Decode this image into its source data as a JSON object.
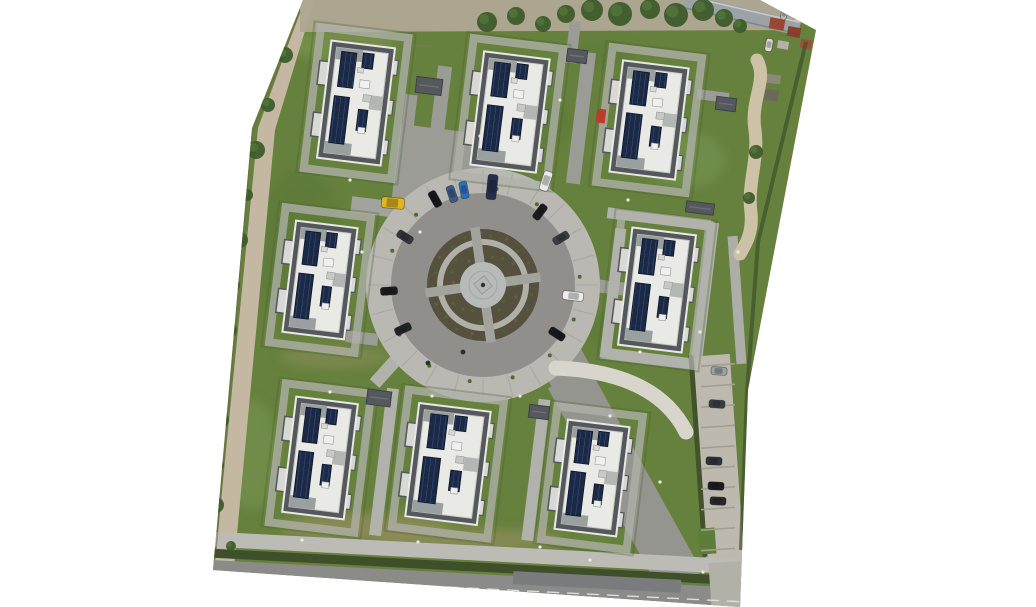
{
  "scene": {
    "description": "aerial-orthophoto-residential-estate-eight-buildings-around-circular-courtyard",
    "canvas": {
      "width": 1036,
      "height": 607
    },
    "boundary_polygon": [
      [
        303,
        0
      ],
      [
        760,
        0
      ],
      [
        816,
        30
      ],
      [
        748,
        390
      ],
      [
        740,
        607
      ],
      [
        213,
        570
      ],
      [
        252,
        128
      ]
    ],
    "colors": {
      "canvas_bg": "#ffffff",
      "grass": "#66813d",
      "asphalt_path": "#9c9c97",
      "light_walkway": "#b2b2ac",
      "plaza_arm": "#a3a39e",
      "drive": "#95958f",
      "ring_outer_pavement": "#b9b8b2",
      "ring_joint": "#a7a6a0",
      "ring_asphalt": "#908f8b",
      "planting": "#56503e",
      "ring_path": "#b0b0a9",
      "plaza": "#b6bbb9",
      "plaza_diamond": "#b2b7b5",
      "building_parapet": "#54575b",
      "building_roof": "#e9e9e5",
      "building_trim": "#e8e8e5",
      "terrace": "#9aa0a0",
      "bay": "#d8d8d4",
      "solar_dark": "#1b2945",
      "solar_line": "#3d5c94",
      "shed": "#55585c",
      "dirt_left": "#c4b8a2",
      "dirt_top": "#b0a694",
      "foliage": "#3d5c2b",
      "foliage_light": "#54763a",
      "hedge": "#3f4f2a",
      "sidewalk": "#bcbbb5",
      "road": "#8b8b89",
      "road_patch": "#7a7b7d",
      "road_line": "#dedede",
      "parking": "#bdb9ae",
      "parking_divider": "#a29e92",
      "parking_hedge": "#42522c",
      "green_patch": "#5d7d3a",
      "beige_path": "#cdc2a6",
      "ramp_wall": "#d8d6cc",
      "long_roof": "#9ba3a7",
      "white_dot": "#eceae4",
      "tuft": "#4e6b33",
      "fence_brown": "#6f6450",
      "hedge_dark": "#3c512b",
      "garden_wall": "#8a7458"
    },
    "left_dirt_polygon": [
      [
        305,
        -2
      ],
      [
        258,
        128
      ],
      [
        215,
        562
      ],
      [
        234,
        566
      ],
      [
        275,
        130
      ],
      [
        315,
        -2
      ]
    ],
    "top_dirt_polygon": [
      [
        300,
        -2
      ],
      [
        792,
        -2
      ],
      [
        795,
        30
      ],
      [
        300,
        32
      ]
    ],
    "lawn_patches": [
      [
        340,
        45,
        55,
        16,
        "#7a9650",
        0.7
      ],
      [
        300,
        250,
        45,
        80,
        "#5a7836",
        0.6
      ],
      [
        365,
        527,
        85,
        13,
        "#938e5e",
        0.75
      ],
      [
        470,
        540,
        95,
        11,
        "#938e5e",
        0.7
      ],
      [
        620,
        330,
        38,
        18,
        "#5a7836",
        0.5
      ],
      [
        685,
        160,
        40,
        28,
        "#779552",
        0.6
      ],
      [
        252,
        455,
        26,
        55,
        "#779552",
        0.55
      ],
      [
        545,
        122,
        28,
        22,
        "#5a7836",
        0.5
      ],
      [
        432,
        470,
        26,
        36,
        "#5f7c38",
        0.5
      ],
      [
        335,
        357,
        55,
        11,
        "#8a8c58",
        0.6
      ],
      [
        605,
        55,
        30,
        14,
        "#5a7836",
        0.5
      ],
      [
        480,
        250,
        30,
        22,
        "#5d7a37",
        0.4
      ]
    ],
    "paths": [
      [
        447,
        167,
        102,
        74,
        7,
        "#9c9c97"
      ],
      [
        390,
        209,
        78,
        16,
        7,
        "#a3a39e"
      ],
      [
        441,
        100,
        14,
        68,
        7,
        "#9c9c97"
      ],
      [
        407,
        132,
        12,
        75,
        7,
        "#9c9c97"
      ],
      [
        581,
        118,
        14,
        132,
        7,
        "#9c9c97"
      ],
      [
        573,
        42,
        11,
        42,
        7,
        "#9c9c97"
      ],
      [
        607,
        287,
        38,
        13,
        7,
        "#9c9c97"
      ],
      [
        659,
        219,
        104,
        11,
        7,
        "#b2b2ac"
      ],
      [
        705,
        292,
        11,
        140,
        7,
        "#b2b2ac"
      ],
      [
        613,
        293,
        11,
        130,
        7,
        "#b2b2ac"
      ],
      [
        661,
        360,
        108,
        11,
        7,
        "#b2b2ac"
      ],
      [
        737,
        300,
        10,
        128,
        -4,
        "#aeaea8"
      ],
      [
        384,
        462,
        12,
        148,
        7,
        "#b2b2ac"
      ],
      [
        536,
        470,
        12,
        142,
        7,
        "#b2b2ac"
      ],
      [
        394,
        362,
        13,
        58,
        42,
        "#b2b2ac"
      ],
      [
        362,
        338,
        32,
        12,
        7,
        "#9c9c97"
      ],
      [
        567,
        369,
        44,
        46,
        -29,
        "#95958f"
      ],
      [
        625,
        480,
        46,
        235,
        -29,
        "#95958f"
      ],
      [
        718,
        458,
        38,
        206,
        -4,
        "#bdb9ae"
      ],
      [
        698,
        456,
        5,
        202,
        -4,
        "#42522c"
      ],
      [
        707,
        541,
        17,
        26,
        -4,
        "#5d7d3a"
      ],
      [
        476,
        553,
        548,
        15,
        3,
        "#bcbbb5"
      ],
      [
        476,
        567,
        548,
        9,
        3,
        "#3f4f2a"
      ],
      [
        477,
        589,
        550,
        30,
        3,
        "#8b8b89"
      ],
      [
        597,
        582,
        168,
        13,
        3,
        "#7a7b7d"
      ],
      [
        727,
        585,
        34,
        46,
        -4,
        "#b3b0a7"
      ],
      [
        713,
        96,
        32,
        10,
        7,
        "#9c9c97"
      ],
      [
        773,
        79,
        15,
        9,
        7,
        "#8d887a"
      ],
      [
        770,
        95,
        17,
        11,
        7,
        "#6b685c"
      ],
      [
        742,
        15,
        118,
        15,
        13,
        "#9ba3a7"
      ],
      [
        742,
        9,
        118,
        1.5,
        13,
        "#c5cbce"
      ],
      [
        742,
        21,
        118,
        1.5,
        13,
        "#7e868a"
      ],
      [
        777,
        24,
        15,
        11,
        10,
        "#9c4632"
      ],
      [
        794,
        32,
        13,
        10,
        10,
        "#8a3f2e"
      ],
      [
        806,
        44,
        11,
        9,
        10,
        "#a04c38"
      ],
      [
        783,
        45,
        11,
        8,
        10,
        "#b5b0a8"
      ],
      [
        800,
        18,
        10,
        8,
        10,
        "#c9c5bd"
      ]
    ],
    "parking_dividers": {
      "cx": 718,
      "y0": 365,
      "step": 20.5,
      "count": 10,
      "w": 34,
      "rot": -4
    },
    "curves": [
      {
        "d": "M 757 60 C 768 80 750 100 755 130 C 759 158 747 185 751 212 C 753 232 746 244 740 254",
        "w": 13,
        "color": "#cdc2a6",
        "dash": ""
      },
      {
        "d": "M 556 368 Q 656 372 686 432",
        "w": 15,
        "color": "#d8d6cc",
        "dash": ""
      },
      {
        "d": "M 208 575 L 746 602",
        "w": 1.4,
        "color": "#dedede",
        "dash": "11 9"
      }
    ],
    "fences": [
      {
        "d": "M 300 12 L 252 132 L 216 550",
        "w": 1.5,
        "color": "#6f6450",
        "op": 0.55
      },
      {
        "d": "M 806 42 L 758 242 L 747 392 L 741 550",
        "w": 4,
        "color": "#3c512b",
        "op": 0.7
      },
      {
        "d": "M 312 96 L 319 38 L 434 47",
        "w": 1.5,
        "color": "#8a7458",
        "op": 0.5
      }
    ],
    "roundabout": {
      "cx": 483,
      "cy": 285,
      "rings": [
        [
          90,
          117,
          "#b9b8b2"
        ],
        [
          55,
          92,
          "#908f8b"
        ],
        [
          45,
          56,
          "#56503e"
        ],
        [
          39,
          46,
          "#b0b0a9"
        ],
        [
          22,
          40,
          "#56503e"
        ]
      ],
      "plaza_r": 23,
      "inner_circle_r": 14,
      "diamond": 13,
      "diamond_rot": 52,
      "arm_angles": [
        352,
        82,
        172,
        262
      ],
      "arm_r1": 21,
      "arm_r2": 58,
      "arm_w": 9.5,
      "joints": 24,
      "tufts": 14
    },
    "building_template": {
      "inset": 6,
      "solar_strips": [
        {
          "x": 0.18,
          "y": 0.08,
          "w": 0.24,
          "h": 0.3
        },
        {
          "x": 0.15,
          "y": 0.46,
          "w": 0.24,
          "h": 0.4
        },
        {
          "x": 0.52,
          "y": 0.07,
          "w": 0.17,
          "h": 0.13
        },
        {
          "x": 0.55,
          "y": 0.55,
          "w": 0.15,
          "h": 0.18
        }
      ],
      "roof_boxes": [
        [
          0.52,
          0.3,
          10,
          8,
          "#f0f0ee"
        ],
        [
          0.6,
          0.42,
          8,
          7,
          "#c8c8c5"
        ],
        [
          0.46,
          0.2,
          6,
          5,
          "#d8d8d5"
        ],
        [
          0.58,
          0.7,
          7,
          6,
          "#eeeeec"
        ]
      ],
      "bays_y": [
        0.18,
        0.62
      ],
      "bumps_y": [
        0.1,
        0.44,
        0.78
      ]
    },
    "buildings": [
      {
        "id": 1,
        "x": 356,
        "y": 103,
        "w": 64,
        "h": 118,
        "rot": 7
      },
      {
        "id": 2,
        "x": 510,
        "y": 112,
        "w": 66,
        "h": 114,
        "rot": 7
      },
      {
        "id": 3,
        "x": 649,
        "y": 120,
        "w": 66,
        "h": 112,
        "rot": 7
      },
      {
        "id": 4,
        "x": 320,
        "y": 280,
        "w": 62,
        "h": 112,
        "rot": 7
      },
      {
        "id": 5,
        "x": 657,
        "y": 290,
        "w": 64,
        "h": 118,
        "rot": 7
      },
      {
        "id": 6,
        "x": 320,
        "y": 458,
        "w": 62,
        "h": 116,
        "rot": 7
      },
      {
        "id": 7,
        "x": 448,
        "y": 464,
        "w": 72,
        "h": 114,
        "rot": 7
      },
      {
        "id": 8,
        "x": 592,
        "y": 478,
        "w": 62,
        "h": 110,
        "rot": 7
      }
    ],
    "red_awning": {
      "x": 601,
      "y": 116,
      "w": 9,
      "h": 14,
      "rot": 7,
      "color": "#c03a2c"
    },
    "sheds": [
      [
        429,
        86,
        26,
        16,
        7
      ],
      [
        577,
        56,
        20,
        13,
        7
      ],
      [
        726,
        104,
        20,
        13,
        7
      ],
      [
        379,
        398,
        24,
        15,
        7
      ],
      [
        539,
        412,
        20,
        13,
        7
      ],
      [
        700,
        208,
        28,
        11,
        7
      ]
    ],
    "cars": [
      [
        393,
        203,
        5,
        "#e3b51c",
        23,
        11
      ],
      [
        435,
        199,
        61,
        "#15171a",
        17,
        8
      ],
      [
        452,
        194,
        71,
        "#3b5a8c",
        17,
        8
      ],
      [
        464,
        190,
        79,
        "#2a6fc2",
        17,
        8
      ],
      [
        492,
        187,
        96,
        "#232f4d",
        25,
        10
      ],
      [
        546,
        181,
        108,
        "#e9e9e7",
        20,
        9
      ],
      [
        540,
        212,
        127,
        "#1a1c1f",
        17,
        8
      ],
      [
        561,
        238,
        149,
        "#3a3d42",
        17,
        8
      ],
      [
        573,
        296,
        187,
        "#ececea",
        21,
        9
      ],
      [
        557,
        334,
        213,
        "#17191c",
        17,
        8
      ],
      [
        405,
        237,
        32,
        "#33363b",
        17,
        8
      ],
      [
        389,
        291,
        -4,
        "#1a1c1f",
        17,
        8
      ],
      [
        403,
        329,
        -25,
        "#212327",
        17,
        8
      ],
      [
        719,
        371,
        4,
        "#9da1a6",
        16,
        8
      ],
      [
        717,
        404,
        4,
        "#3a3d42",
        16,
        8
      ],
      [
        714,
        461,
        3,
        "#303337",
        16,
        8
      ],
      [
        716,
        486,
        3,
        "#1a1c1f",
        16,
        8
      ],
      [
        718,
        501,
        3,
        "#26282c",
        16,
        8
      ],
      [
        769,
        45,
        100,
        "#dcdad4",
        13,
        7
      ],
      [
        784,
        14,
        100,
        "#b9b6af",
        12,
        6
      ]
    ],
    "left_shrubs": [
      [
        285,
        55,
        8
      ],
      [
        268,
        105,
        7
      ],
      [
        256,
        150,
        9
      ],
      [
        247,
        195,
        6
      ],
      [
        240,
        240,
        8
      ],
      [
        234,
        285,
        6
      ],
      [
        229,
        330,
        8
      ],
      [
        224,
        375,
        6
      ],
      [
        221,
        420,
        8
      ],
      [
        218,
        465,
        6
      ],
      [
        216,
        505,
        8
      ],
      [
        231,
        546,
        5
      ]
    ],
    "top_foliage": [
      [
        487,
        22,
        10
      ],
      [
        516,
        16,
        9
      ],
      [
        543,
        24,
        8
      ],
      [
        566,
        14,
        9
      ],
      [
        592,
        10,
        11
      ],
      [
        620,
        14,
        12
      ],
      [
        650,
        9,
        10
      ],
      [
        676,
        15,
        12
      ],
      [
        703,
        10,
        11
      ],
      [
        724,
        18,
        9
      ],
      [
        740,
        26,
        7
      ],
      [
        756,
        152,
        7
      ],
      [
        749,
        198,
        6
      ]
    ],
    "white_dots": [
      [
        373,
        145
      ],
      [
        420,
        232
      ],
      [
        362,
        252
      ],
      [
        330,
        392
      ],
      [
        302,
        540
      ],
      [
        418,
        542
      ],
      [
        540,
        547
      ],
      [
        640,
        352
      ],
      [
        700,
        332
      ],
      [
        628,
        200
      ],
      [
        560,
        100
      ],
      [
        480,
        136
      ],
      [
        610,
        416
      ],
      [
        660,
        482
      ],
      [
        703,
        572
      ],
      [
        738,
        252
      ],
      [
        432,
        396
      ],
      [
        520,
        396
      ],
      [
        350,
        180
      ],
      [
        590,
        560
      ]
    ],
    "dark_dots": [
      [
        428,
        363
      ],
      [
        463,
        352
      ]
    ]
  }
}
